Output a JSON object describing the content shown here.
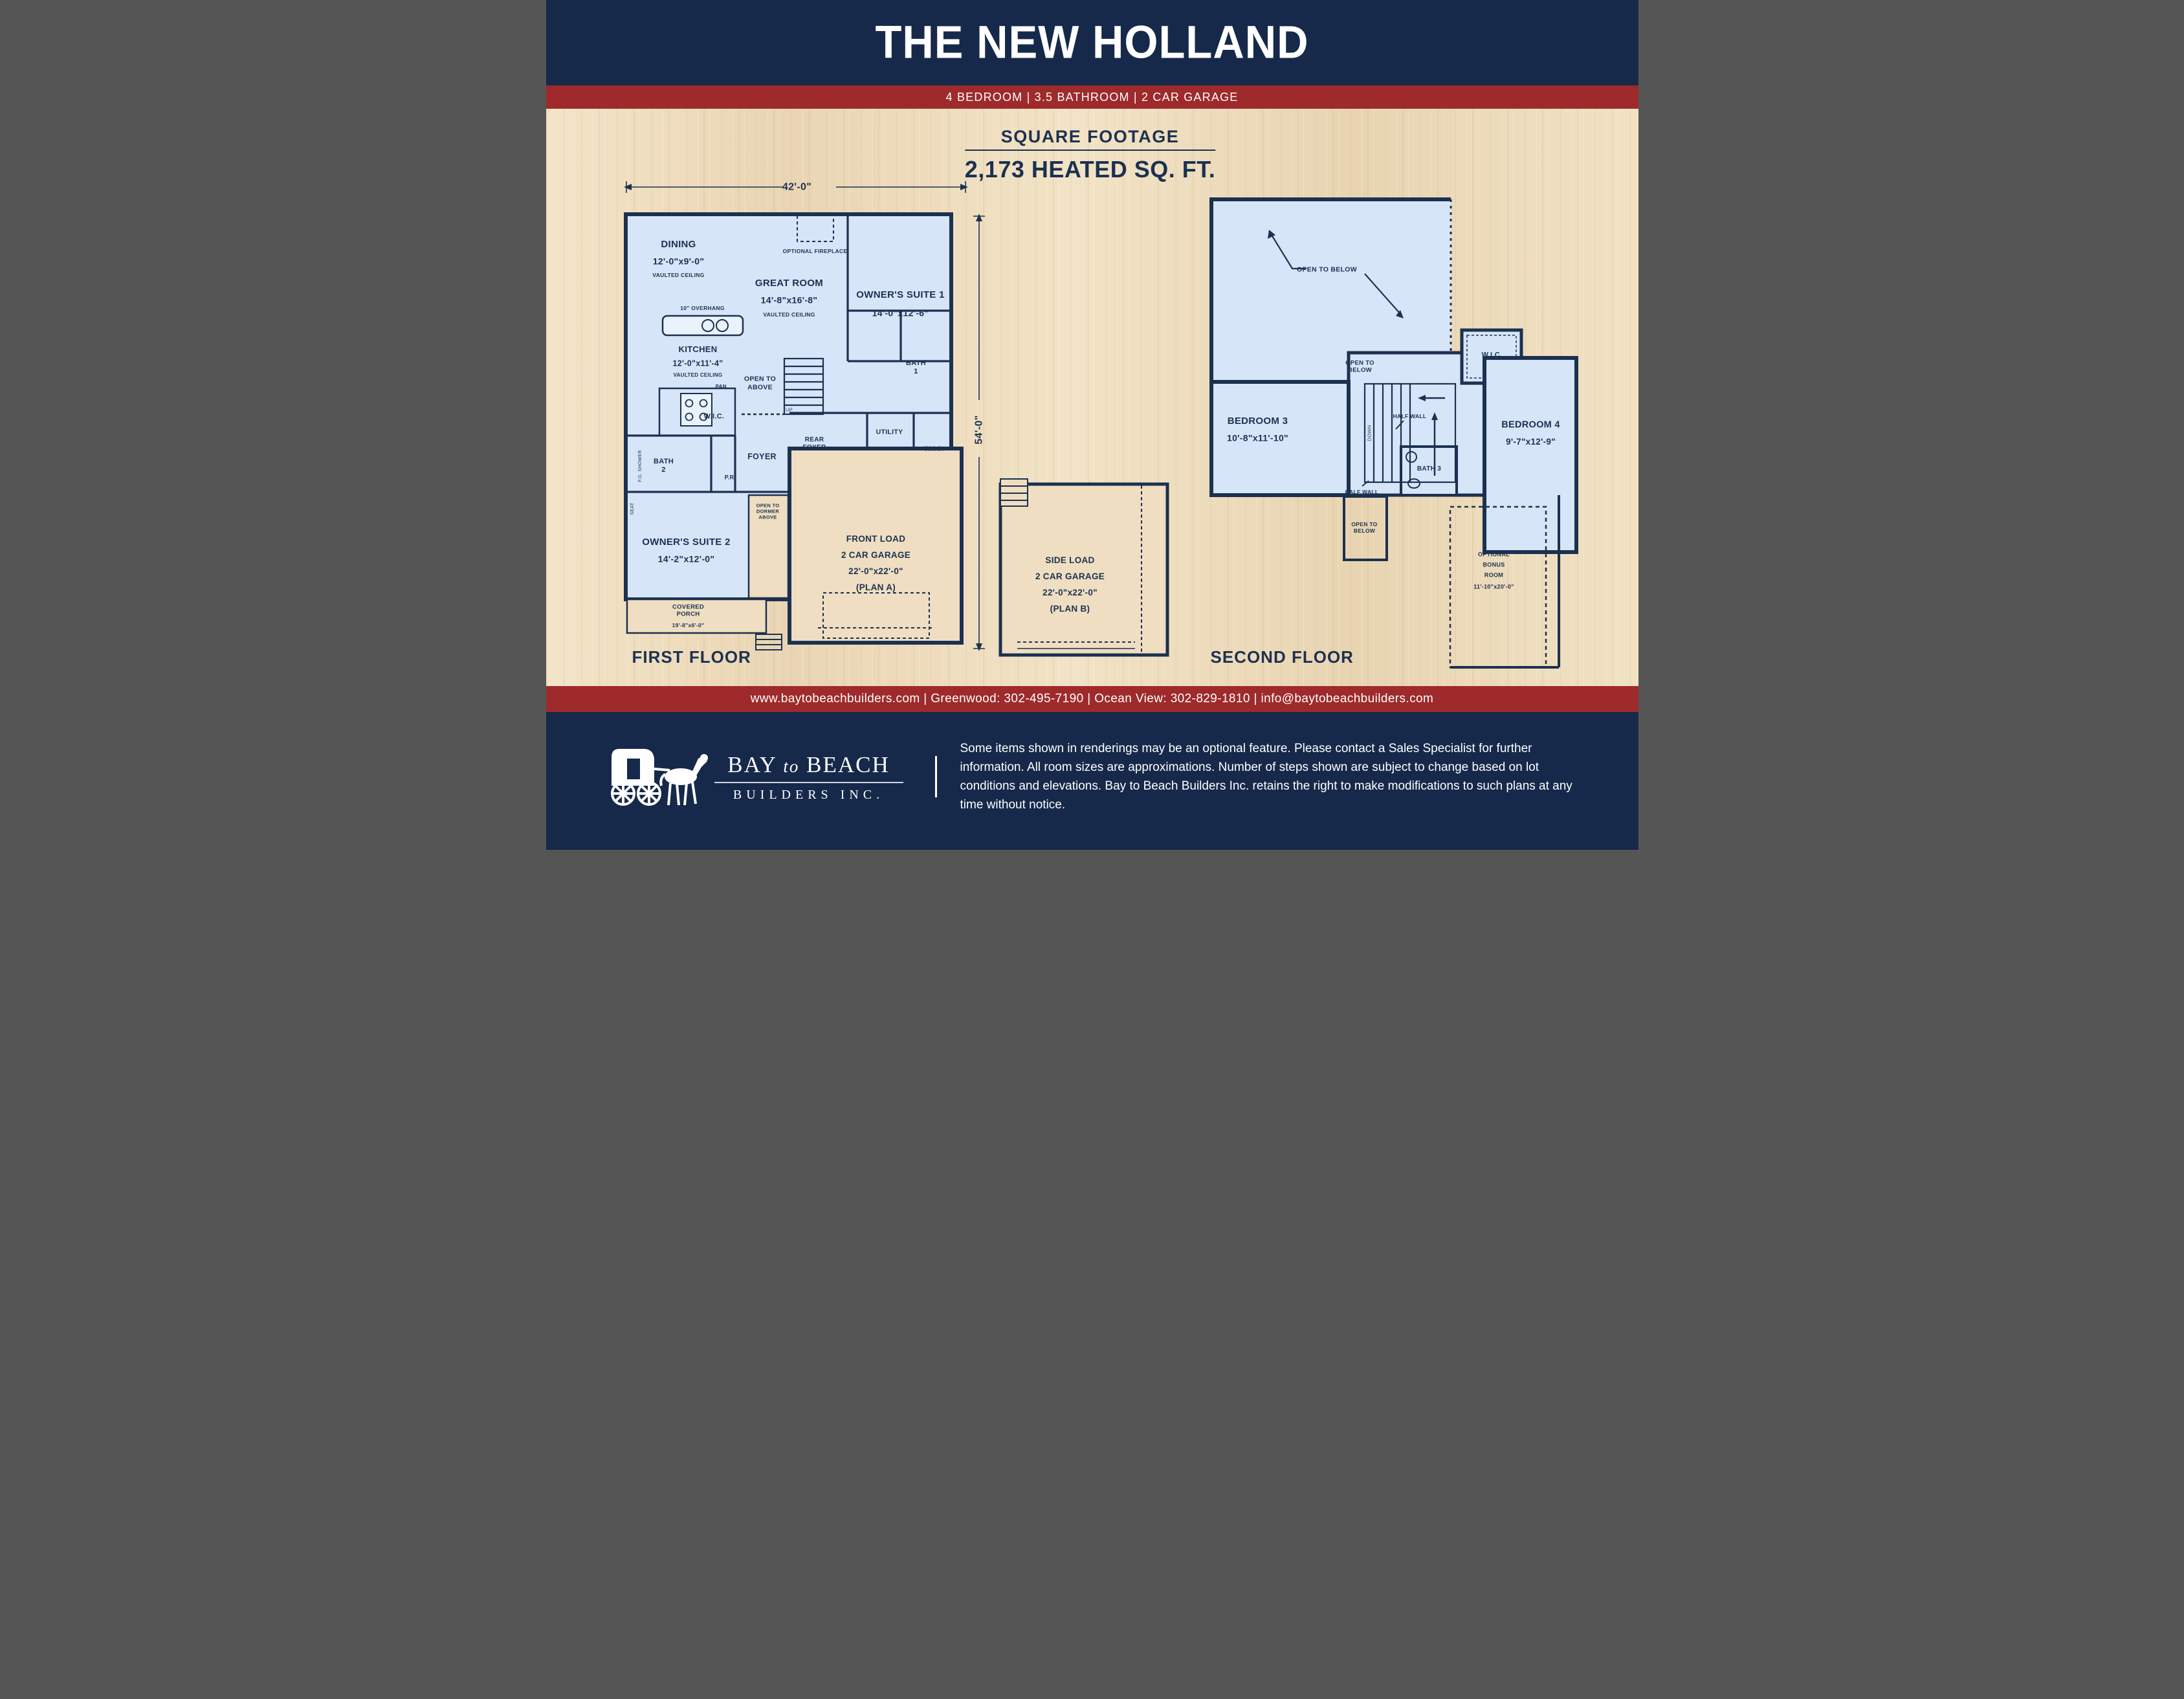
{
  "header": {
    "title": "THE NEW HOLLAND",
    "subtitle": "4 BEDROOM | 3.5 BATHROOM | 2 CAR GARAGE"
  },
  "square_footage": {
    "heading": "SQUARE FOOTAGE",
    "value": "2,173 HEATED SQ. FT."
  },
  "first_floor": {
    "title": "FIRST FLOOR",
    "width_dim": "42'-0\"",
    "depth_dim": "54'-0\"",
    "labels": {
      "dining": {
        "name": "DINING",
        "dims": "12'-0\"x9'-0\"",
        "note": "VAULTED CEILING"
      },
      "optional_fireplace": "OPTIONAL FIREPLACE",
      "great_room": {
        "name": "GREAT ROOM",
        "dims": "14'-8\"x16'-8\"",
        "note": "VAULTED CEILING"
      },
      "owners_suite_1": {
        "name": "OWNER'S SUITE 1",
        "dims": "14'-0\"x12'-6\""
      },
      "overhang": "10\" OVERHANG",
      "kitchen": {
        "name": "KITCHEN",
        "dims": "12'-0\"x11'-4\"",
        "note": "VAULTED CEILING"
      },
      "pantry": "PAN.",
      "open_to_above": "OPEN TO ABOVE",
      "up": "UP",
      "bath_1": "BATH 1",
      "wic_1": "W.I.C.",
      "bath_2": "BATH 2",
      "fg_shower": "F.G. SHOWER",
      "seat": "SEAT",
      "foyer": "FOYER",
      "pr": "P.R.",
      "rear_foyer": "REAR FOYER",
      "utility": "UTILITY",
      "wic_2": "W.I.C.",
      "open_to_dormer": "OPEN TO DORMER ABOVE",
      "owners_suite_2": {
        "name": "OWNER'S SUITE 2",
        "dims": "14'-2\"x12'-0\""
      },
      "covered_porch": {
        "name": "COVERED PORCH",
        "dims": "19'-8\"x6'-0\""
      },
      "front_garage": {
        "line1": "FRONT LOAD",
        "line2": "2 CAR GARAGE",
        "dims": "22'-0\"x22'-0\"",
        "plan": "(PLAN A)"
      }
    }
  },
  "plan_b_garage": {
    "line1": "SIDE LOAD",
    "line2": "2 CAR GARAGE",
    "dims": "22'-0\"x22'-0\"",
    "plan": "(PLAN B)"
  },
  "second_floor": {
    "title": "SECOND FLOOR",
    "labels": {
      "open_to_below_top": "OPEN TO BELOW",
      "open_to_below_mid": "OPEN TO BELOW",
      "open_to_below_low": "OPEN TO BELOW",
      "wic": "W.I.C.",
      "down": "DOWN",
      "half_wall_1": "HALF WALL",
      "half_wall_2": "HALF WALL",
      "bedroom_3": {
        "name": "BEDROOM 3",
        "dims": "10'-8\"x11'-10\""
      },
      "bath_3": "BATH 3",
      "bedroom_4": {
        "name": "BEDROOM 4",
        "dims": "9'-7\"x12'-9\""
      },
      "bonus": {
        "line1": "OPTIONAL",
        "line2": "BONUS",
        "line3": "ROOM",
        "dims": "11'-10\"x20'-0\""
      }
    }
  },
  "contact_bar": {
    "text": "www.baytobeachbuilders.com | Greenwood: 302-495-7190 | Ocean View: 302-829-1810 | info@baytobeachbuilders.com"
  },
  "footer": {
    "logo_bay": "BAY",
    "logo_to": "to",
    "logo_beach": "BEACH",
    "logo_line2": "BUILDERS INC.",
    "disclaimer": "Some items shown in renderings may be an optional feature. Please contact a Sales Specialist for further information. All room sizes are approximations. Number of steps shown are subject to change based on lot conditions and elevations. Bay to Beach Builders Inc. retains the right to make modifications to such plans at any time without notice."
  },
  "colors": {
    "navy": "#16294a",
    "red": "#9e2a2b",
    "plan_blue": "#d6e5f8",
    "wall_navy": "#1c3150",
    "wood": "#efdec1"
  }
}
